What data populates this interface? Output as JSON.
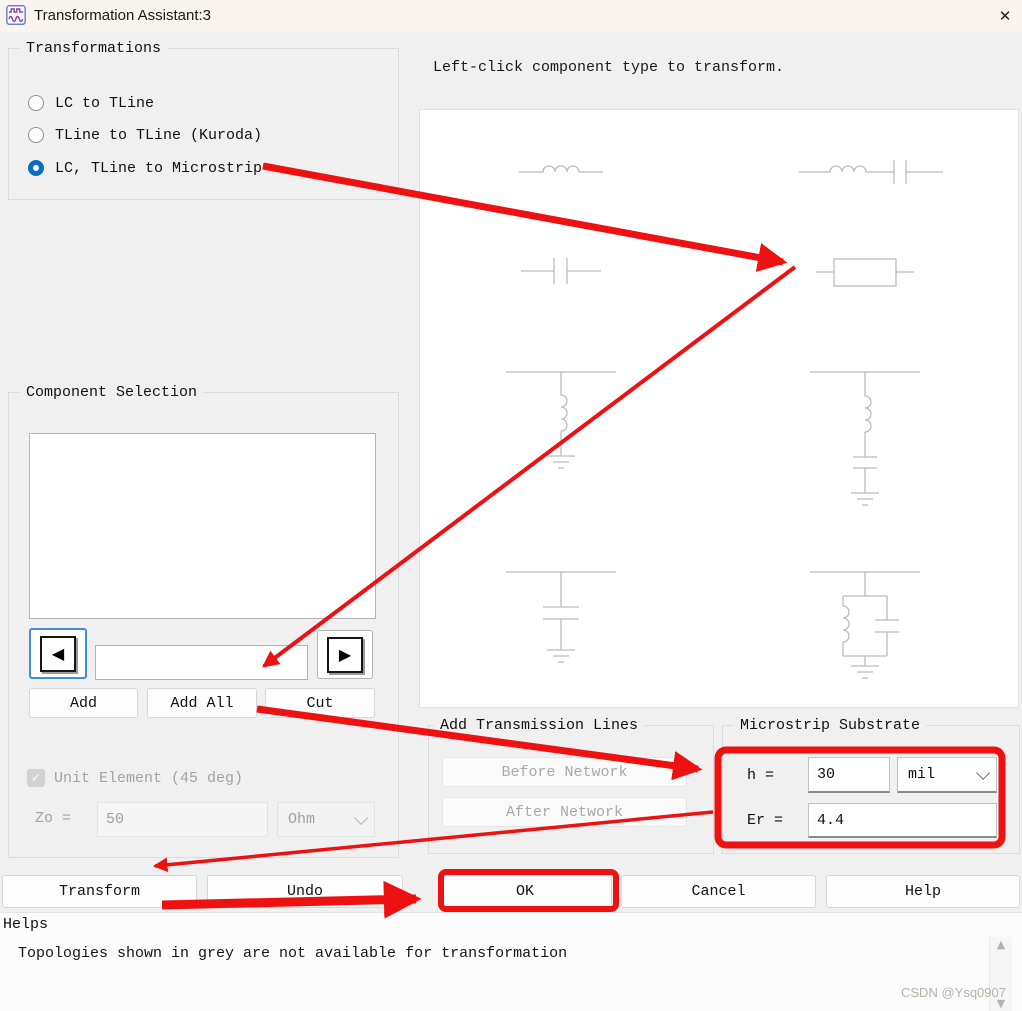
{
  "window": {
    "title": "Transformation Assistant:3"
  },
  "icons": {
    "close": "✕",
    "left_arrow": "◀",
    "right_arrow": "▶",
    "check": "✓",
    "scroll_up": "▲",
    "scroll_down": "▼"
  },
  "transformations": {
    "title": "Transformations",
    "options": [
      {
        "label": "LC to TLine",
        "selected": false
      },
      {
        "label": "TLine to TLine (Kuroda)",
        "selected": false
      },
      {
        "label": "LC, TLine to Microstrip",
        "selected": true
      }
    ]
  },
  "canvas": {
    "instruction": "Left-click component type to transform.",
    "symbols": [
      "series-inductor",
      "series-inductor-capacitor",
      "series-capacitor",
      "series-tline",
      "shunt-inductor",
      "shunt-series-lc",
      "shunt-capacitor",
      "shunt-parallel-lc"
    ]
  },
  "component_selection": {
    "title": "Component Selection",
    "list_items": [],
    "nav_value": "",
    "add_label": "Add",
    "add_all_label": "Add All",
    "cut_label": "Cut",
    "unit_element_label": "Unit Element (45 deg)",
    "unit_element_checked": true,
    "zo_label": "Zo =",
    "zo_value": "50",
    "zo_unit": "Ohm"
  },
  "add_transmission_lines": {
    "title": "Add Transmission Lines",
    "before_label": "Before Network",
    "after_label": "After Network"
  },
  "microstrip_substrate": {
    "title": "Microstrip Substrate",
    "h_label": "h =",
    "h_value": "30",
    "h_unit": "mil",
    "er_label": "Er =",
    "er_value": "4.4"
  },
  "actions": {
    "transform_label": "Transform",
    "undo_label": "Undo",
    "ok_label": "OK",
    "cancel_label": "Cancel",
    "help_label": "Help"
  },
  "helps": {
    "label": "Helps",
    "text": "Topologies shown in grey are not available for transformation"
  },
  "watermark": "CSDN @Ysq0907",
  "colors": {
    "annotation_red": "#ee1111",
    "radio_blue": "#0a6ebd",
    "titlebar_bg": "#f9f4ee",
    "schematic_grey": "#bcbcbc"
  }
}
